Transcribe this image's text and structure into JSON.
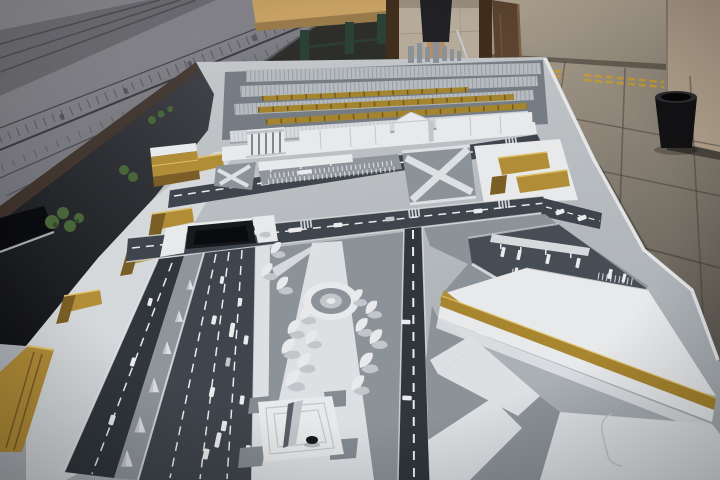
{
  "scene": {
    "type": "photograph",
    "subject": "architectural-scale-model-of-railway-station-district",
    "setting": "exhibition-room-interior",
    "objects": [
      "wall-poster-elevation-drawing",
      "wooden-table",
      "doorway",
      "person-standing",
      "open-door",
      "wall-column",
      "trash-can",
      "tiled-floor",
      "tactile-paving-strips",
      "architectural-model",
      "railway-platform-canopies",
      "gold-train-models",
      "highrise-tower-models",
      "station-buildings",
      "colonnade-portico",
      "cross-streets",
      "car-models",
      "parking-lot",
      "gold-buildings",
      "highway",
      "road-tunnel",
      "median-conifer-trees",
      "pedestrian-plaza",
      "circular-fountain",
      "stylized-white-trees",
      "monument",
      "bus-terminal",
      "bus-models",
      "gold-trimmed-building",
      "green-trees",
      "dark-building-slab"
    ]
  },
  "colors": {
    "posterA": "#96969b",
    "posterB": "#62626a",
    "posterLine": "#34343a",
    "backDark": "#2d2d29",
    "tableWood": "#c7a164",
    "tableWood2": "#997a4a",
    "tableLeg": "#2c4135",
    "doorFrame": "#402e1d",
    "doorPanel": "#5b442f",
    "doorEdge": "#7a5f43",
    "interiorFloor": "#b6ab9a",
    "interiorLine": "#a2967f",
    "skin": "#b48c69",
    "skirt": "#212125",
    "shoe": "#2b2b2f",
    "wallA": "#b2a694",
    "wallB": "#91887a",
    "wallBase": "#645c51",
    "column": "#b2a18d",
    "columnBase": "#4a453e",
    "trashBody": "#121214",
    "trashTop": "#2c2c30",
    "trashInner": "#060607",
    "floorA": "#a79c8c",
    "floorB": "#514e48",
    "grout": "#3c3831",
    "tactile": "#bf9939",
    "modelA": "#c6c9cc",
    "modelB": "#a6acb1",
    "shadowA": "#3e4045",
    "shadowB": "#111216",
    "slab": "#0a0b0e",
    "slabLine": "#ccd0d3",
    "esplanade": "#d5d8db",
    "goldSide": "#b28d38",
    "goldTop": "#ddc169",
    "goldDark": "#7a5e25",
    "railBase": "#767c83",
    "canopy": "#b6bbbf",
    "canopyNear": "#d7dadd",
    "hatch": "#989ea4",
    "train": "#a5842e",
    "trainSeg": "#6e5920",
    "tower": "#8a9198",
    "white": "#e7e9eb",
    "whiteShade": "#c2c6ca",
    "colLine": "#808790",
    "road": "#3f454c",
    "roadNear": "#30363c",
    "roadLine": "#e9ebed",
    "plaza": "#8b9298",
    "path": "#dde0e3",
    "median": "#8f959b",
    "green": "#49663a",
    "greenDark": "#314a27",
    "tunnel": "#16191d",
    "tunnelDeep": "#090b0e",
    "lot": "#474d54",
    "cornice": "#a8852f",
    "figDark": "#17181b",
    "grayPatch": "#848b91",
    "wedge": "#575e66"
  }
}
